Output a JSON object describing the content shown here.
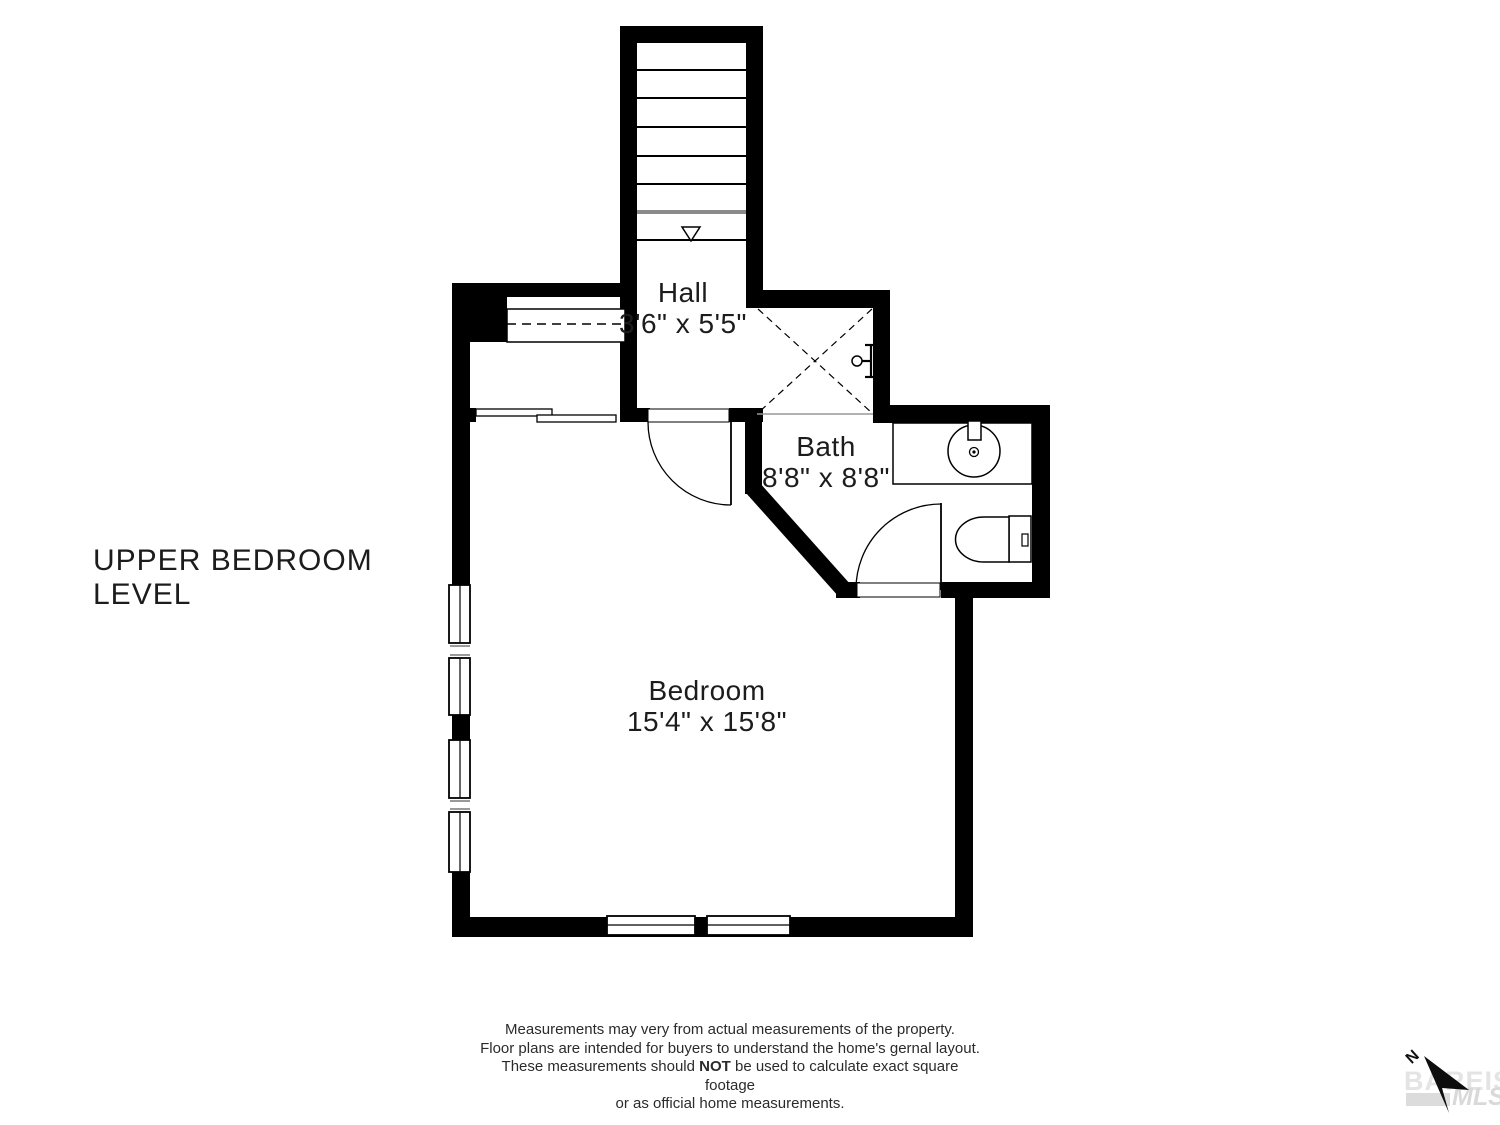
{
  "title": {
    "line1": "UPPER BEDROOM",
    "line2": "LEVEL"
  },
  "rooms": {
    "hall": {
      "name": "Hall",
      "dims": "3'6\" x 5'5\""
    },
    "bath": {
      "name": "Bath",
      "dims": "8'8\" x 8'8\""
    },
    "bedroom": {
      "name": "Bedroom",
      "dims": "15'4\" x 15'8\""
    }
  },
  "disclaimer": {
    "l1": "Measurements may very from actual measurements of the property.",
    "l2": "Floor plans are intended for buyers to understand the home's gernal layout.",
    "l3a": "These measurements should ",
    "l3b": "NOT",
    "l3c": " be used to calculate exact square footage",
    "l4": "or as official home measurements."
  },
  "compass": {
    "north_label": "N"
  },
  "watermark": {
    "brand": "BAREIS®",
    "mls": "MLS"
  },
  "colors": {
    "wall": "#000000",
    "text": "#1c1c1c",
    "stair_break_line": "#8a8a8a",
    "watermark": "#e0e0e0"
  }
}
